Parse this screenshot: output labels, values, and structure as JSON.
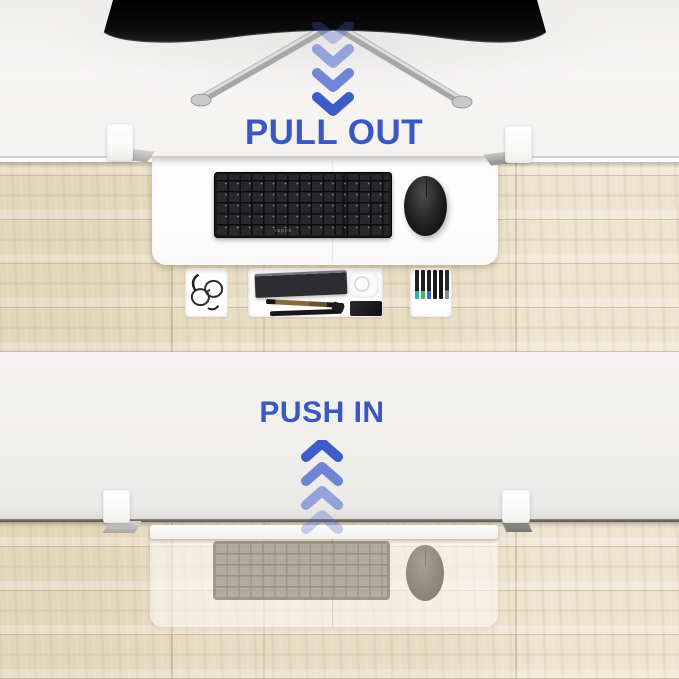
{
  "labels": {
    "pull_out": "PULL OUT",
    "push_in": "PUSH IN"
  },
  "arrows": {
    "top_direction": "down",
    "bottom_direction": "up",
    "count_per_group": 4
  },
  "keyboard": {
    "brand": "rapoo"
  },
  "colors": {
    "accent_blue": "#3B57C1",
    "arrow_blue": "#3E5CC9",
    "monitor_black": "#0A0A0A",
    "desk_white": "#F4F3F1",
    "tray_white": "#FDFDFD",
    "wood_base": "#E8DCC4",
    "keyboard_black": "#1C1C1E",
    "clamp_white": "#FCFCFC"
  }
}
